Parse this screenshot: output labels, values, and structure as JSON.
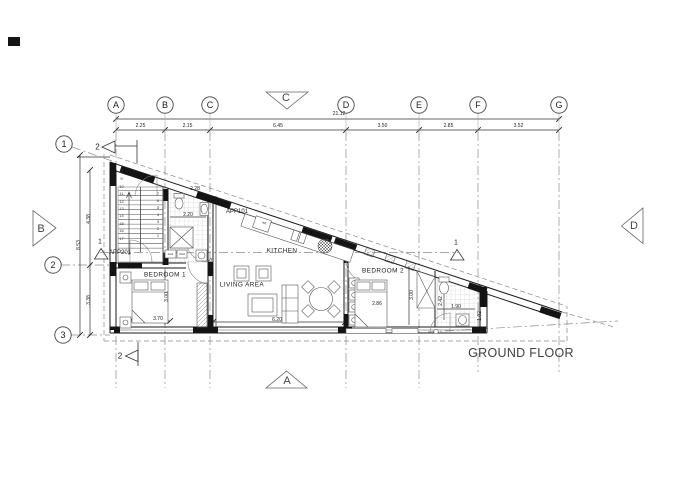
{
  "drawing": {
    "floor_label": "GROUND FLOOR",
    "apartments": {
      "upper": "APP201",
      "lower": "APP101"
    },
    "rooms": {
      "kitchen": "KITCHEN",
      "living": "LIVING AREA",
      "bedroom1": "BEDROOM 1",
      "bedroom2": "BEDROOM 2"
    }
  },
  "grid": {
    "columns": [
      "A",
      "B",
      "C",
      "D",
      "E",
      "F",
      "G"
    ],
    "rows": [
      "1",
      "2",
      "3"
    ],
    "column_dims": [
      "2.25",
      "2.15",
      "6.45",
      "3.50",
      "2.85",
      "3.52"
    ],
    "total_width": "21.12",
    "row_dims": [
      "4.38",
      "3.38"
    ],
    "total_height": "8.53"
  },
  "elevation_markers": {
    "top": "C",
    "bottom": "A",
    "left": "B",
    "right": "D"
  },
  "section_markers": {
    "section1": "1",
    "section2": "2"
  },
  "dims": {
    "bath1_top": "2.28",
    "bath1_width": "2.20",
    "bed1_width": "3.70",
    "bed1_depth": "3.00",
    "living_width": "6.20",
    "living_depth": "6.35",
    "bed2_width": "2.86",
    "bed2_depth": "3.00",
    "bath2_depth": "2.42",
    "bath2_width": "1.90",
    "bath2_tip": "1.02"
  },
  "labels": {
    "fridge": "ref",
    "door_tag_1": "AH1",
    "door_tag_2": "AH2"
  },
  "stairs": {
    "flight_up": "8\n9\n10\n11\n12\n13\n14\n15\n16\n17",
    "flight_down": "7\n6\n5\n4\n3\n2\n1"
  },
  "colors": {
    "line": "#1a1a1a",
    "wall": "#141414",
    "grid": "#8a8a8a",
    "tile": "#c5c5c5",
    "text": "#1c1c1c",
    "floor_text": "#3f3f3f"
  }
}
